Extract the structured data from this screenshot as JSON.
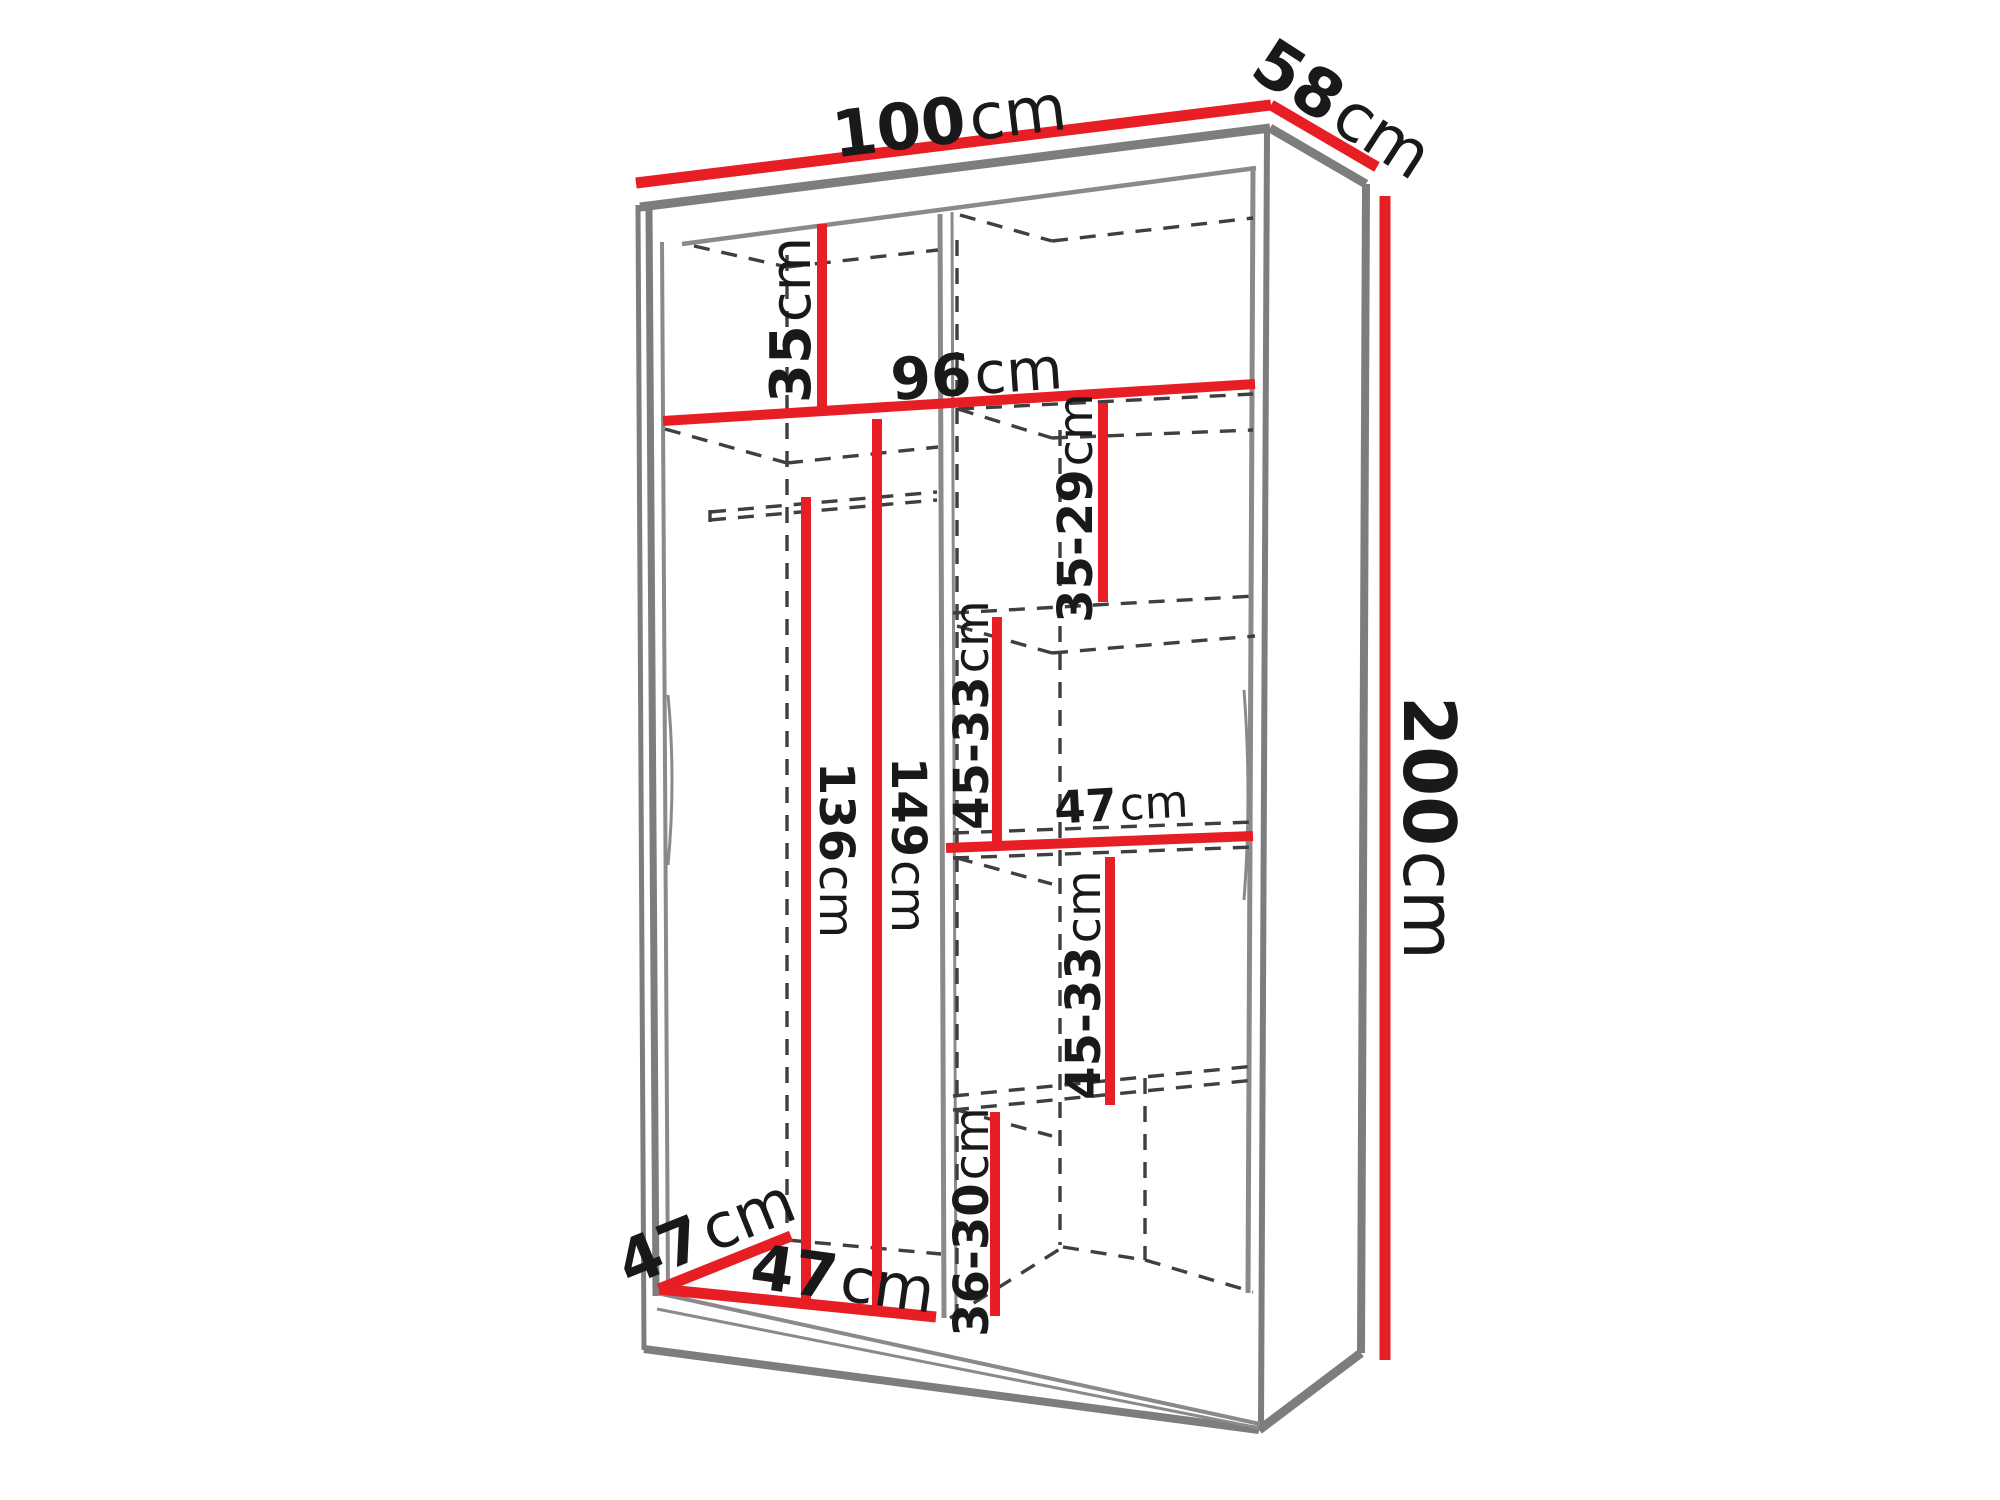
{
  "diagram": {
    "kind": "wardrobe interior dimension drawing",
    "unit": "cm",
    "colors": {
      "dimension_line": "#e81e25",
      "cabinet_edge": "#7d7d7d",
      "hidden_edge": "#3f3f3f",
      "label_text": "#191919",
      "background": "#ffffff"
    }
  },
  "labels": {
    "overall_width": {
      "value": "100",
      "unit": "cm"
    },
    "overall_depth": {
      "value": "58",
      "unit": "cm"
    },
    "overall_height": {
      "value": "200",
      "unit": "cm"
    },
    "top_compartment": {
      "value": "35",
      "unit": "cm"
    },
    "interior_width": {
      "value": "96",
      "unit": "cm"
    },
    "right_shelf_1": {
      "value": "35-29",
      "unit": "cm"
    },
    "right_shelf_2": {
      "value": "45-33",
      "unit": "cm"
    },
    "right_shelf_width": {
      "value": "47",
      "unit": "cm"
    },
    "right_shelf_3": {
      "value": "45-33",
      "unit": "cm"
    },
    "right_shelf_4": {
      "value": "36-30",
      "unit": "cm"
    },
    "rail_height": {
      "value": "136",
      "unit": "cm"
    },
    "left_interior_height": {
      "value": "149",
      "unit": "cm"
    },
    "left_width": {
      "value": "47",
      "unit": "cm"
    },
    "left_depth": {
      "value": "47",
      "unit": "cm"
    }
  }
}
